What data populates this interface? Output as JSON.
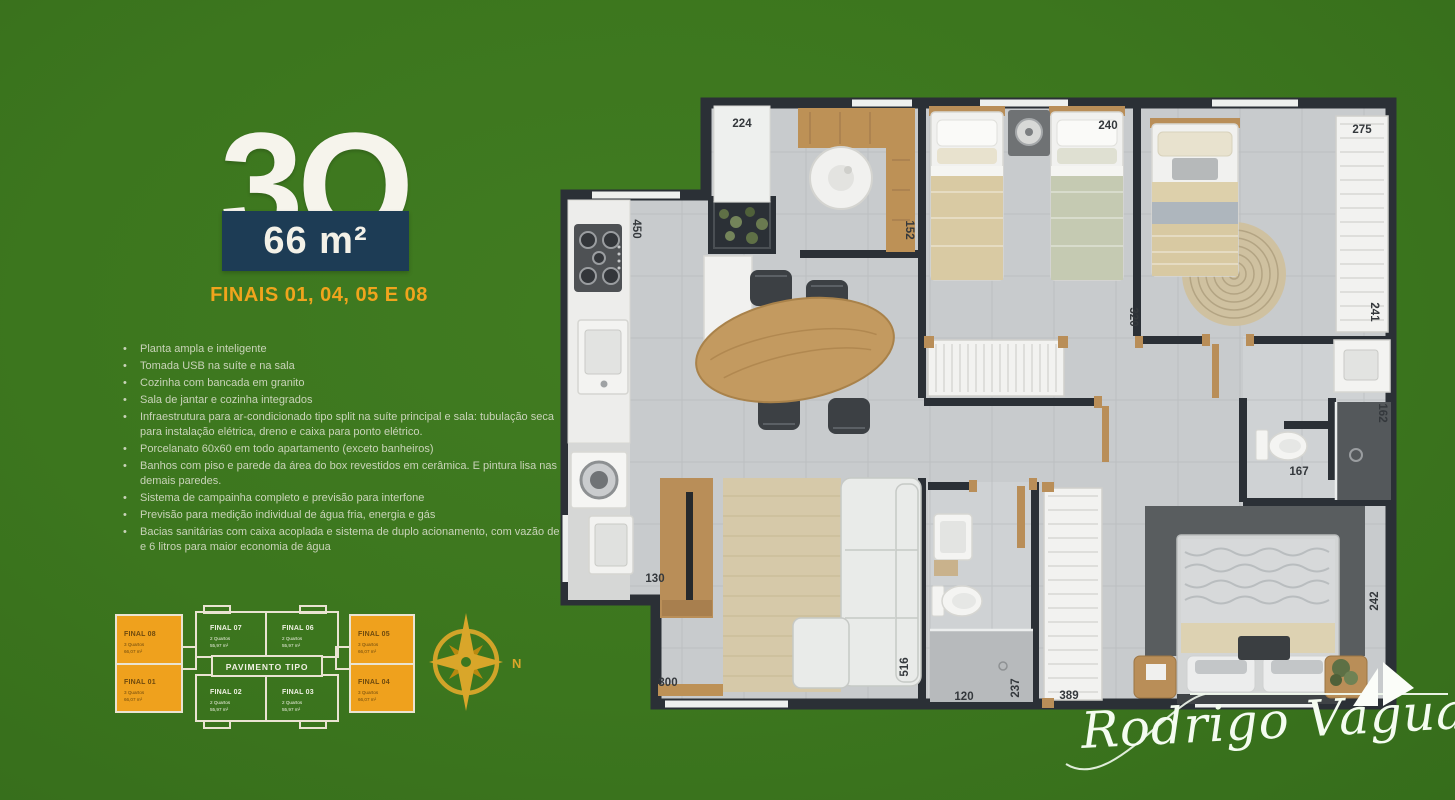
{
  "colors": {
    "background_green": "#3c761e",
    "badge_navy": "#1d3c55",
    "accent_orange": "#f0a41d",
    "title_cream": "#f6f4ec",
    "feature_text": "#c9d3b9",
    "plan_wall": "#2b3036",
    "plan_floor": "#c8cbcd",
    "wood": "#bd9156",
    "compass_gold": "#d9a62a",
    "signature_white": "#f4fcf0"
  },
  "header": {
    "title": "3Q",
    "area": "66 m²",
    "finais": "FINAIS 01, 04, 05 E 08"
  },
  "features": [
    "Planta ampla e inteligente",
    "Tomada USB na suíte e na sala",
    "Cozinha com bancada em granito",
    "Sala de jantar e cozinha integrados",
    "Infraestrutura para ar-condicionado tipo split na suíte principal e sala: tubulação seca para instalação elétrica, dreno e caixa para ponto elétrico.",
    "Porcelanato 60x60 em todo apartamento (exceto banheiros)",
    "Banhos com piso e parede da área do box revestidos em cerâmica. E pintura lisa nas demais paredes.",
    "Sistema de campainha completo e previsão para interfone",
    "Previsão para medição individual de água fria, energia e gás",
    "Bacias sanitárias com caixa acoplada e sistema de duplo acionamento, com vazão de 3 e 6 litros para maior economia de água"
  ],
  "minimap": {
    "center_label": "PAVIMENTO TIPO",
    "units": [
      {
        "name": "FINAL 08",
        "line1": "3 Quartos",
        "line2": "66,07 m²",
        "highlight": true
      },
      {
        "name": "FINAL 07",
        "line1": "2 Quartos",
        "line2": "55,97 m²",
        "highlight": false
      },
      {
        "name": "FINAL 06",
        "line1": "2 Quartos",
        "line2": "55,97 m²",
        "highlight": false
      },
      {
        "name": "FINAL 05",
        "line1": "3 Quartos",
        "line2": "66,07 m²",
        "highlight": true
      },
      {
        "name": "FINAL 01",
        "line1": "3 Quartos",
        "line2": "66,07 m²",
        "highlight": true
      },
      {
        "name": "FINAL 02",
        "line1": "2 Quartos",
        "line2": "55,97 m²",
        "highlight": false
      },
      {
        "name": "FINAL 03",
        "line1": "2 Quartos",
        "line2": "55,97 m²",
        "highlight": false
      },
      {
        "name": "FINAL 04",
        "line1": "3 Quartos",
        "line2": "66,07 m²",
        "highlight": true
      }
    ]
  },
  "compass": {
    "north_label": "N"
  },
  "plan": {
    "dims": {
      "d224": "224",
      "d450": "450",
      "d152": "152",
      "d240": "240",
      "d275": "275",
      "d320": "320",
      "d241": "241",
      "d162": "162",
      "d167": "167",
      "d130": "130",
      "d300": "300",
      "d516": "516",
      "d120": "120",
      "d237": "237",
      "d389": "389",
      "d242": "242"
    }
  },
  "signature": {
    "name": "Rodrigo Vaguary"
  }
}
